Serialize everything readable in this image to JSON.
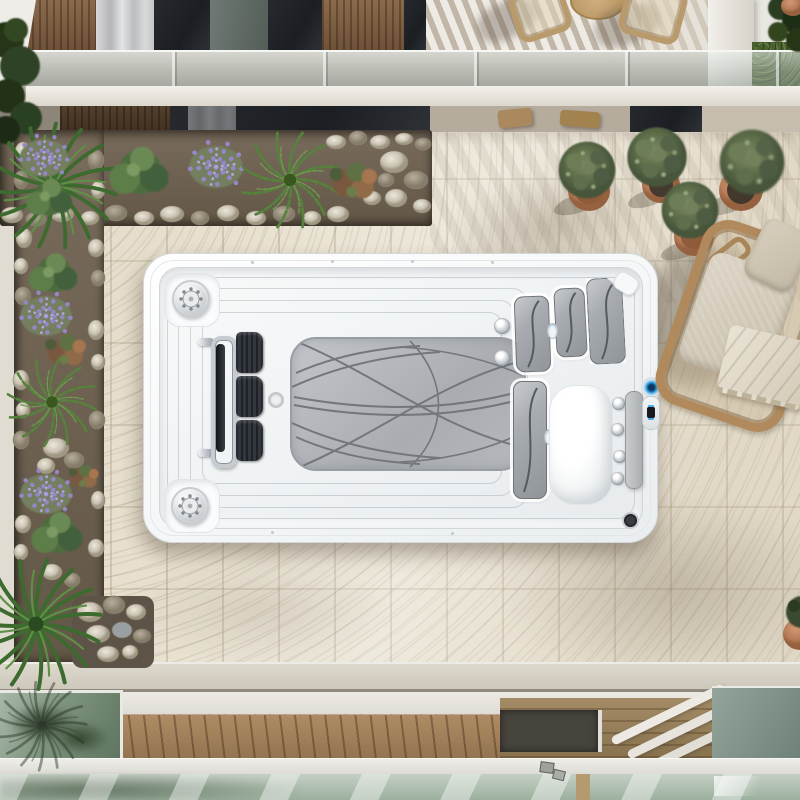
{
  "scene": {
    "description": "aerial-view-swim-spa-on-travertine-patio",
    "objects": [
      "swim-spa",
      "gray-floor-mat",
      "corner-massage-jets",
      "chrome-grab-rail",
      "black-jet-pads",
      "seat-pads",
      "lounge-cushion",
      "control-panel",
      "blue-led-light",
      "travertine-patio",
      "top-planter",
      "left-planter",
      "pebbles",
      "palm",
      "fern",
      "lavender",
      "shrubs",
      "terracotta-pots",
      "olive-shrubs",
      "wicker-lounge-chair",
      "blanket",
      "pillow",
      "building-facade",
      "glass-balustrade",
      "balcony-chairs",
      "balcony-table",
      "hedge",
      "grass-patch",
      "wood-deck",
      "glass-skylight",
      "glass-railing"
    ],
    "palette": {
      "travertine": "#e8e1d0",
      "grout": "#968a70",
      "spa_white": "#f7f9fa",
      "mat_gray": "#b0b3b8",
      "pad_gray": "#a8acb1",
      "accent_blue": "#2f9ce2",
      "terracotta": "#bf8261",
      "foliage_green": "#4c6b3c",
      "lavender_purple": "#9488c4",
      "wood_brown": "#8a6a4b",
      "deck_brown": "#a5825d",
      "glass_green": "#9cb09e",
      "soil_brown": "#6b5f50"
    },
    "counts": {
      "terracotta_pots": 5,
      "corner_jets": 2,
      "seat_pads": 5,
      "balcony_chairs": 2
    }
  }
}
